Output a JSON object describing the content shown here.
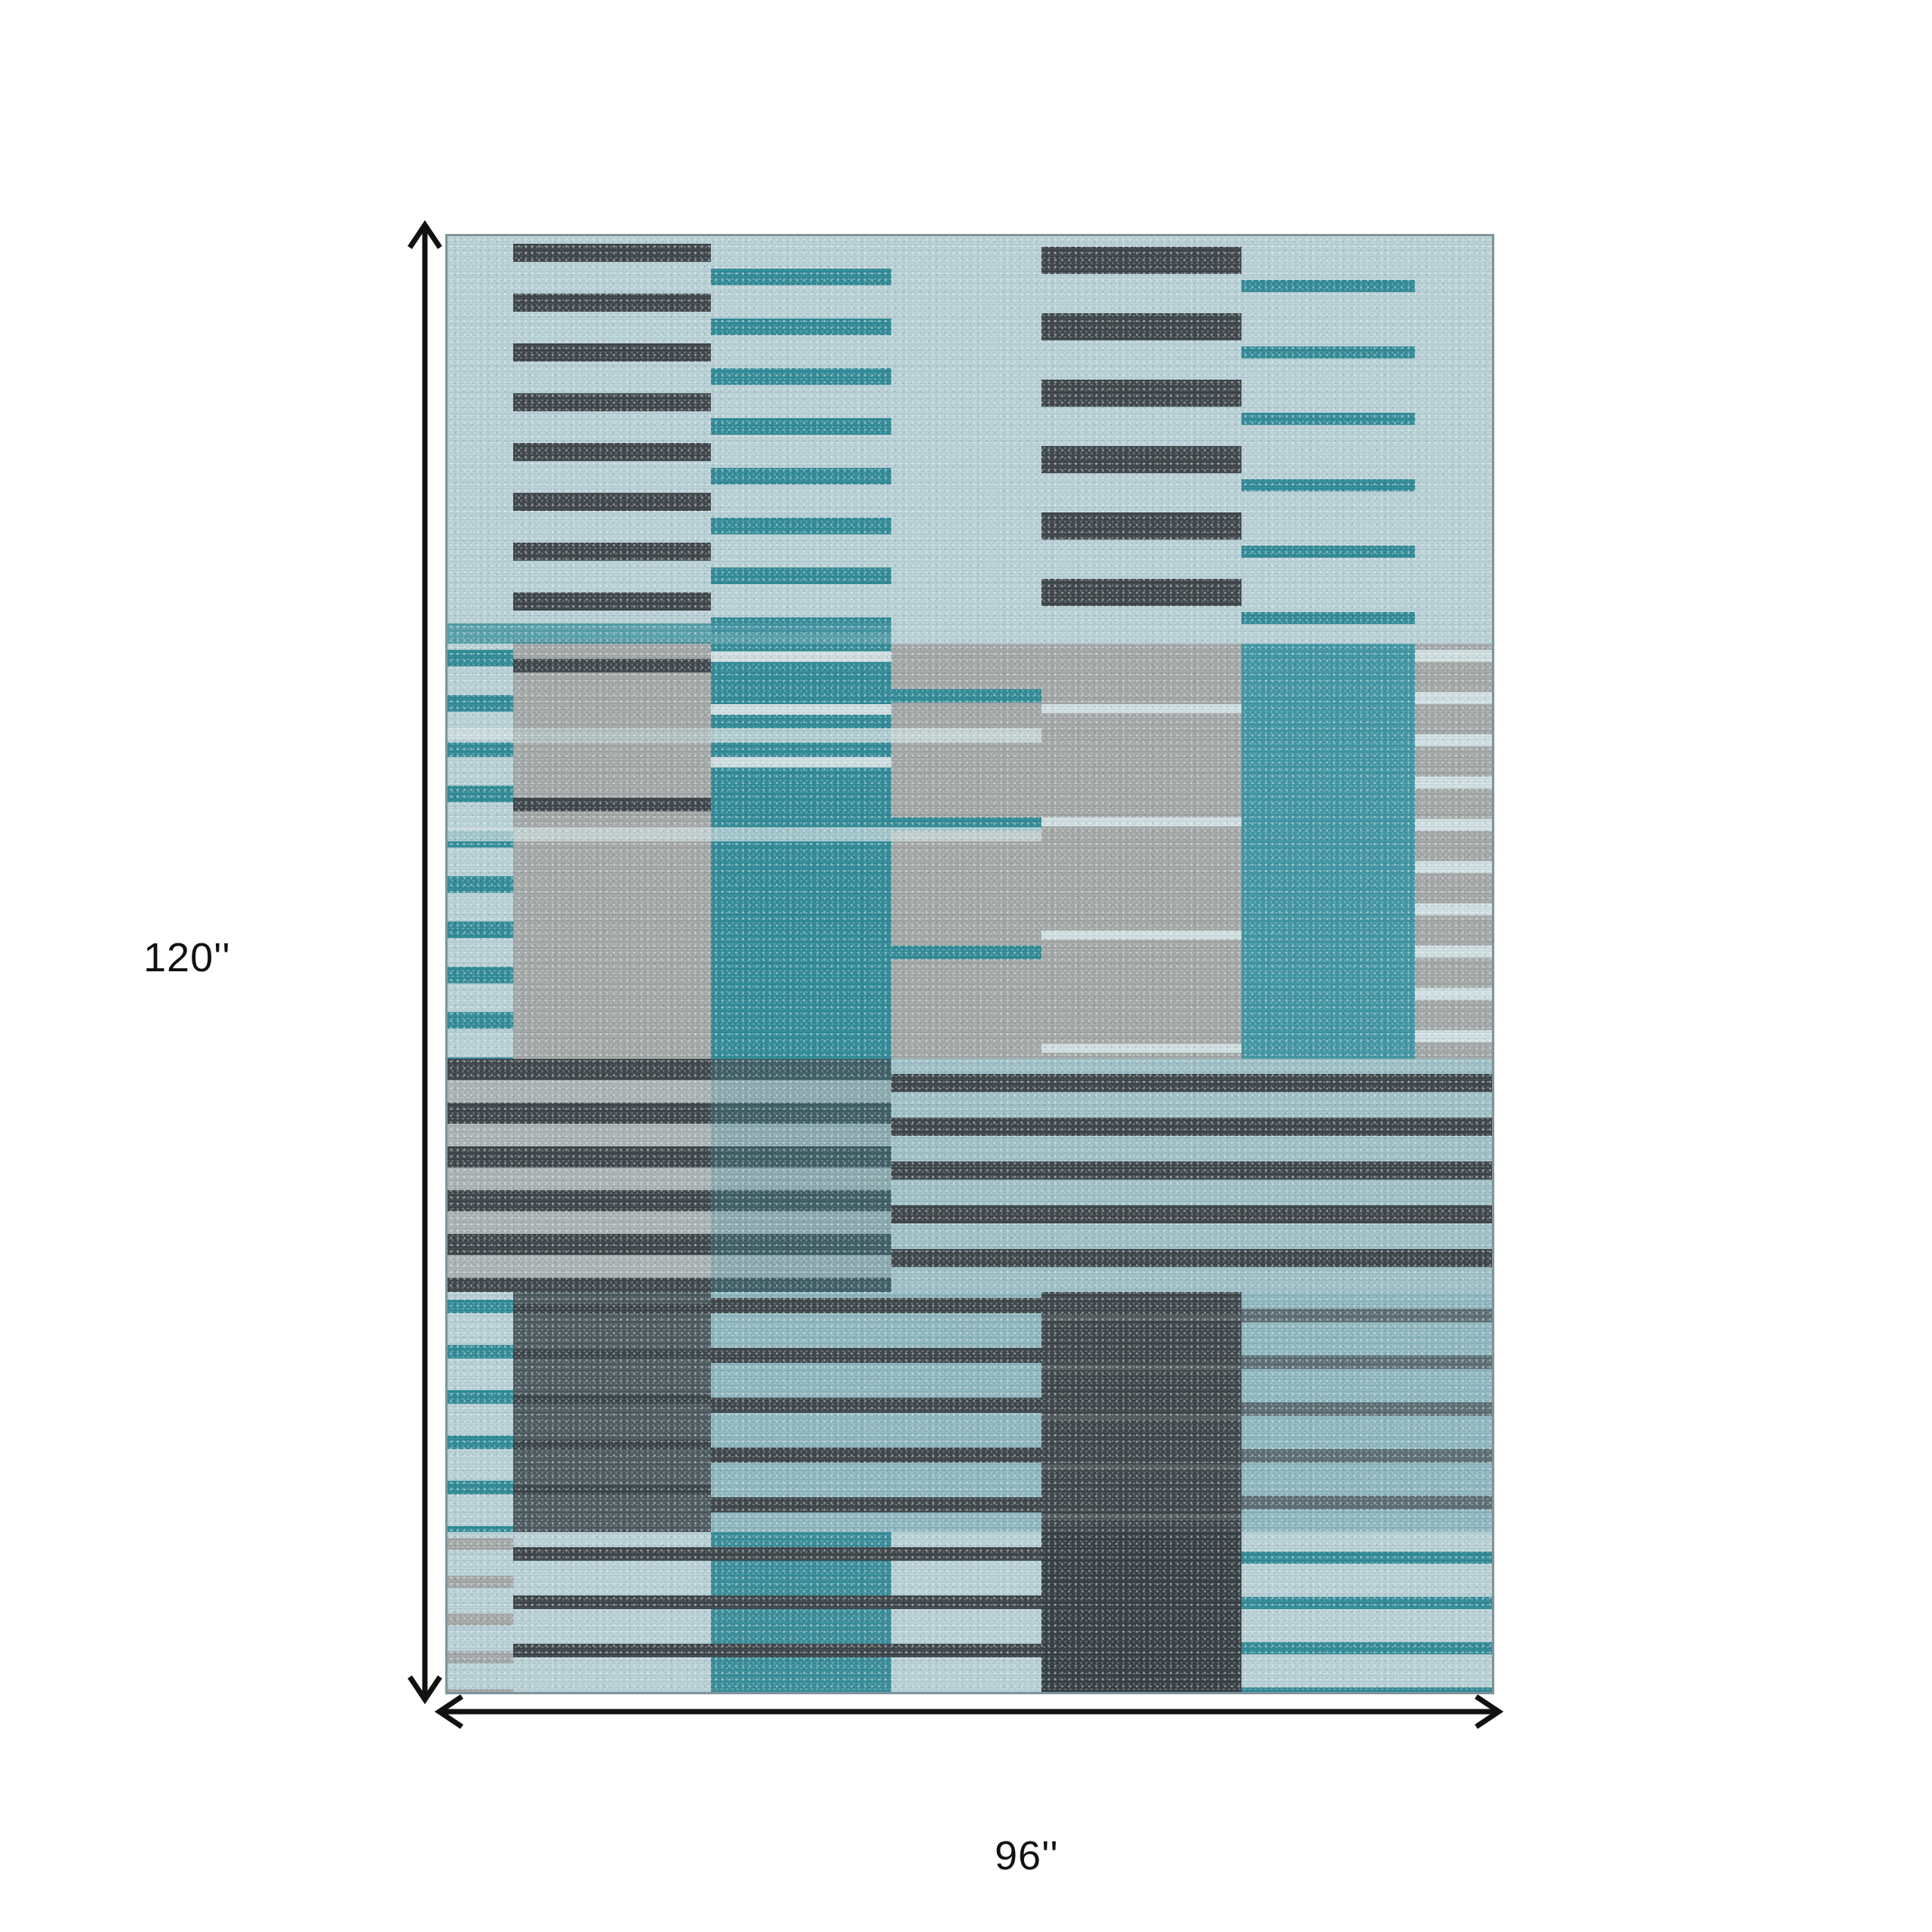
{
  "diagram": {
    "height_label": "120''",
    "width_label": "96''"
  },
  "colors": {
    "background": "#ffffff",
    "arrow": "#111111",
    "rug_border": "#7e949b",
    "light_blue": "#b7d0d5",
    "pale_row": "#cfdee0",
    "teal": "#2f8997",
    "teal_block": "#3f95a3",
    "gray_block": "#a2a7a6",
    "charcoal": "#3c4448",
    "dark_slate": "#4b585e",
    "aqua": "#8db6be",
    "slate_stripe": "#5a6b72"
  },
  "rug": {
    "patches": [
      {
        "x": 0,
        "y": 0,
        "w": 6.3,
        "h": 28,
        "bg": "#b7d0d5"
      },
      {
        "x": 6.3,
        "y": 0,
        "w": 18.9,
        "h": 28,
        "bg": "#b7d0d5",
        "stripe": {
          "color": "#3c4448",
          "size": 24,
          "period": 66,
          "offset": 10
        }
      },
      {
        "x": 25.2,
        "y": 0,
        "w": 17.3,
        "h": 28,
        "bg": "#b7d0d5",
        "stripe": {
          "color": "#2f8997",
          "size": 22,
          "period": 66,
          "offset": 43
        }
      },
      {
        "x": 42.5,
        "y": 0,
        "w": 14.4,
        "h": 28,
        "bg": "#b7d0d5"
      },
      {
        "x": 56.9,
        "y": 0,
        "w": 19.1,
        "h": 28,
        "bg": "#b7d0d5",
        "stripe": {
          "color": "#3c4448",
          "size": 36,
          "period": 88,
          "offset": 14
        }
      },
      {
        "x": 76.0,
        "y": 0,
        "w": 16.6,
        "h": 28,
        "bg": "#b7d0d5",
        "stripe": {
          "color": "#2f8997",
          "size": 16,
          "period": 88,
          "offset": 58
        }
      },
      {
        "x": 92.6,
        "y": 0,
        "w": 7.4,
        "h": 28,
        "bg": "#b7d0d5"
      },
      {
        "x": 0,
        "y": 26.6,
        "w": 42.5,
        "h": 1.5,
        "bg": "#4596a3",
        "op": 0.85
      },
      {
        "x": 0,
        "y": 28,
        "w": 6.3,
        "h": 28.5,
        "bg": "#b7d0d5",
        "stripe": {
          "color": "#2f8997",
          "size": 22,
          "period": 60,
          "offset": 8
        }
      },
      {
        "x": 6.3,
        "y": 28,
        "w": 18.9,
        "h": 12.5,
        "bg": "#a2a7a6",
        "stripe": {
          "color": "#3c4448",
          "size": 18,
          "period": 92,
          "offset": 20
        }
      },
      {
        "x": 6.3,
        "y": 40.5,
        "w": 18.9,
        "h": 16,
        "bg": "#a2a7a6"
      },
      {
        "x": 25.2,
        "y": 28,
        "w": 17.3,
        "h": 9,
        "bg": "#2f8997",
        "stripe": {
          "color": "#cfdee0",
          "size": 14,
          "period": 70,
          "offset": 10
        }
      },
      {
        "x": 25.2,
        "y": 37,
        "w": 17.3,
        "h": 19.5,
        "bg": "#2f8997"
      },
      {
        "x": 42.5,
        "y": 28,
        "w": 14.4,
        "h": 28.5,
        "bg": "#a2a7a6",
        "stripe": {
          "color": "#2f8997",
          "size": 18,
          "period": 170,
          "offset": 60
        }
      },
      {
        "x": 56.9,
        "y": 28,
        "w": 19.1,
        "h": 28.5,
        "bg": "#a2a7a6",
        "stripe": {
          "color": "#cfdee0",
          "size": 12,
          "period": 150,
          "offset": 80
        }
      },
      {
        "x": 76.0,
        "y": 28,
        "w": 16.6,
        "h": 28.5,
        "bg": "#3f95a3"
      },
      {
        "x": 92.6,
        "y": 28,
        "w": 7.4,
        "h": 28.5,
        "bg": "#a2a7a6",
        "stripe": {
          "color": "#cfdee0",
          "size": 16,
          "period": 56,
          "offset": 8
        }
      },
      {
        "x": 0,
        "y": 33.8,
        "w": 56.9,
        "h": 1.0,
        "bg": "#cfdee0",
        "op": 0.8
      },
      {
        "x": 0,
        "y": 40.6,
        "w": 56.9,
        "h": 1.0,
        "bg": "#cfdee0",
        "op": 0.7
      },
      {
        "x": 0,
        "y": 56.5,
        "w": 42.5,
        "h": 16,
        "bg": "#a9b2b3",
        "stripe": {
          "color": "#3c4448",
          "size": 28,
          "period": 58,
          "offset": 0
        }
      },
      {
        "x": 42.5,
        "y": 56.5,
        "w": 57.5,
        "h": 16,
        "bg": "#9dbfc6",
        "stripe": {
          "color": "#3c4448",
          "size": 24,
          "period": 58,
          "offset": 20
        }
      },
      {
        "x": 25.2,
        "y": 56.5,
        "w": 17.3,
        "h": 16,
        "bg": "rgba(63,149,163,0.30)"
      },
      {
        "x": 0,
        "y": 72.5,
        "w": 6.3,
        "h": 16.5,
        "bg": "#b7d0d5",
        "stripe": {
          "color": "#2f8997",
          "size": 18,
          "period": 60,
          "offset": 10
        }
      },
      {
        "x": 6.3,
        "y": 72.5,
        "w": 18.9,
        "h": 16.5,
        "bg": "#4b585e",
        "stripe": {
          "color": "rgba(0,0,0,0.25)",
          "size": 12,
          "period": 60,
          "offset": 16
        }
      },
      {
        "x": 25.2,
        "y": 72.5,
        "w": 31.7,
        "h": 16.5,
        "bg": "#8db6be",
        "stripe": {
          "color": "#3c4448",
          "size": 20,
          "period": 66,
          "offset": 8
        }
      },
      {
        "x": 56.9,
        "y": 72.5,
        "w": 19.1,
        "h": 16.5,
        "bg": "#3c4448",
        "stripe": {
          "color": "rgba(255,255,255,0.10)",
          "size": 8,
          "period": 66,
          "offset": 30
        }
      },
      {
        "x": 76.0,
        "y": 72.5,
        "w": 24.0,
        "h": 16.5,
        "bg": "#8db6be",
        "stripe": {
          "color": "#5a6b72",
          "size": 18,
          "period": 62,
          "offset": 22
        }
      },
      {
        "x": 0,
        "y": 89,
        "w": 6.3,
        "h": 11,
        "bg": "#b7d0d5",
        "stripe": {
          "color": "#a2a7a6",
          "size": 16,
          "period": 50,
          "offset": 8
        }
      },
      {
        "x": 6.3,
        "y": 89,
        "w": 18.9,
        "h": 11,
        "bg": "#b7d0d5",
        "stripe": {
          "color": "#3c4448",
          "size": 18,
          "period": 64,
          "offset": 20
        }
      },
      {
        "x": 25.2,
        "y": 89,
        "w": 17.3,
        "h": 11,
        "bg": "#368b99",
        "stripe": {
          "color": "#3c4448",
          "size": 18,
          "period": 64,
          "offset": 20
        }
      },
      {
        "x": 42.5,
        "y": 89,
        "w": 14.4,
        "h": 11,
        "bg": "#b7d0d5",
        "stripe": {
          "color": "#3c4448",
          "size": 18,
          "period": 64,
          "offset": 20
        }
      },
      {
        "x": 56.9,
        "y": 89,
        "w": 19.1,
        "h": 11,
        "bg": "#343c41"
      },
      {
        "x": 76.0,
        "y": 89,
        "w": 24.0,
        "h": 11,
        "bg": "#b7d0d5",
        "stripe": {
          "color": "#2f8997",
          "size": 16,
          "period": 60,
          "offset": 26
        }
      }
    ]
  }
}
